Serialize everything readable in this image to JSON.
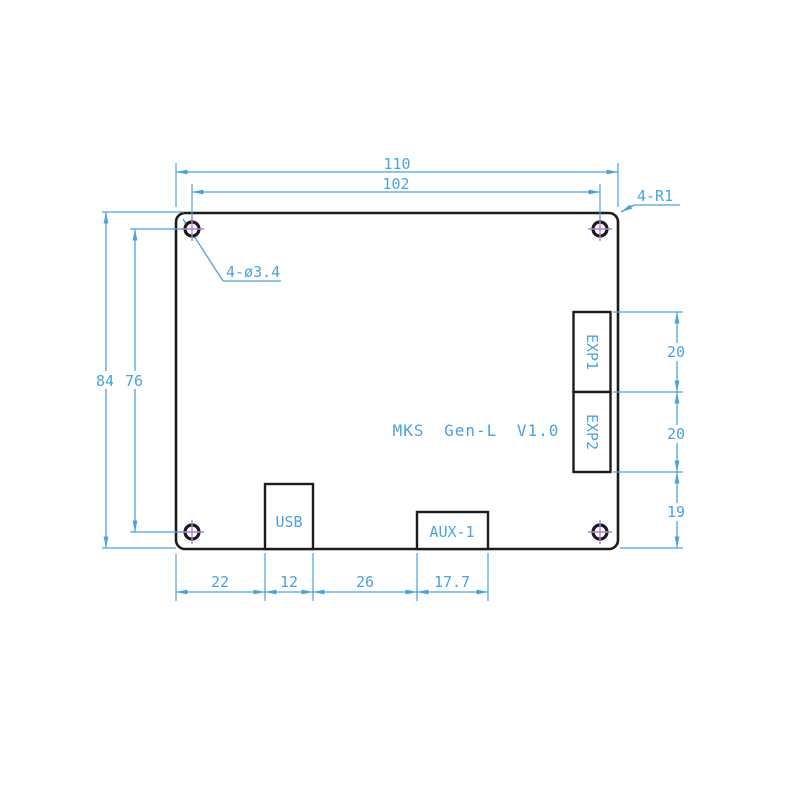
{
  "drawing": {
    "title": "MKS Gen-L V1.0",
    "notes": {
      "corner_radius": "4-R1",
      "hole_diameter": "4-ø3.4"
    },
    "connectors": {
      "exp1": "EXP1",
      "exp2": "EXP2",
      "usb": "USB",
      "aux1": "AUX-1"
    },
    "dimensions": {
      "board_width": "110",
      "hole_span_width": "102",
      "board_height": "84",
      "hole_span_height": "76",
      "exp1_height": "20",
      "exp2_height": "20",
      "exp2_to_bottom": "19",
      "edge_to_usb": "22",
      "usb_width": "12",
      "usb_to_aux": "26",
      "aux_width": "17.7"
    },
    "colors": {
      "dimension_blue": "#4ba3de",
      "outline_black": "#1c1c1c",
      "center_mark_purple": "#b27fd9"
    }
  }
}
